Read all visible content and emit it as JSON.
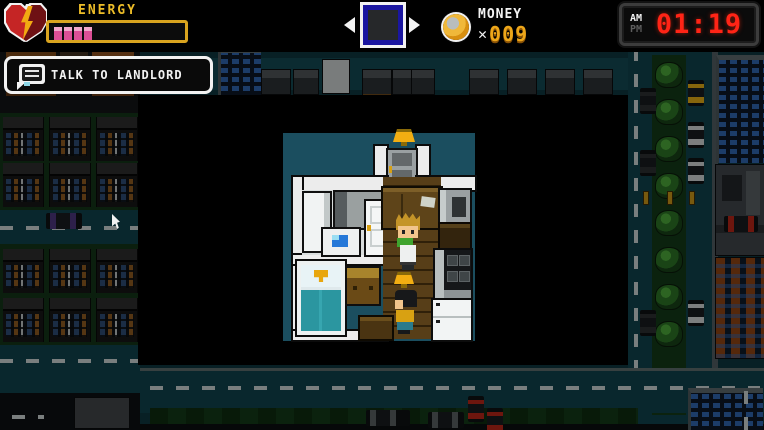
{
  "hud": {
    "energy": {
      "label": "ENERGY",
      "filled_segments": 4,
      "total_segments": 13,
      "segment_color": "#dd4f96",
      "bar_border_color": "#d9a41f",
      "label_color": "#edbd28"
    },
    "money": {
      "label": "MONEY",
      "times_sign": "✕",
      "value": "009",
      "digit_color": "#eda619"
    },
    "clock": {
      "meridiem_am": "AM",
      "meridiem_pm": "PM",
      "active_meridiem": "AM",
      "time": "01:19",
      "digit_color": "#ff2416"
    }
  },
  "prompt": {
    "label": "TALK TO LANDLORD"
  },
  "palette": {
    "apartment_backdrop": "#1b4e5f",
    "street": "#10404a",
    "grass_block": "#123318",
    "overlay_black": "#000000"
  }
}
